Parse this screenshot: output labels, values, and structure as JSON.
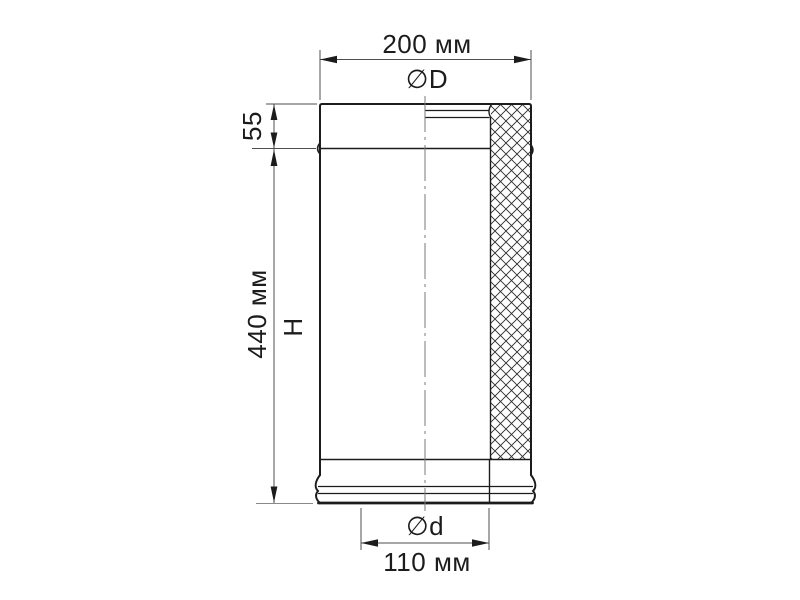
{
  "colors": {
    "background": "#ffffff",
    "outline": "#1c1c1c",
    "dimension_lines": "#4f4f4f",
    "text": "#1c1c1c"
  },
  "dimensions": {
    "outer_width": {
      "value_label": "200 мм",
      "diameter_symbol": "∅D"
    },
    "collar_height": {
      "value_label": "55"
    },
    "body_height": {
      "value_label": "440 мм",
      "height_symbol": "H"
    },
    "inner_width": {
      "diameter_symbol": "∅d",
      "value_label": "110 мм"
    }
  }
}
